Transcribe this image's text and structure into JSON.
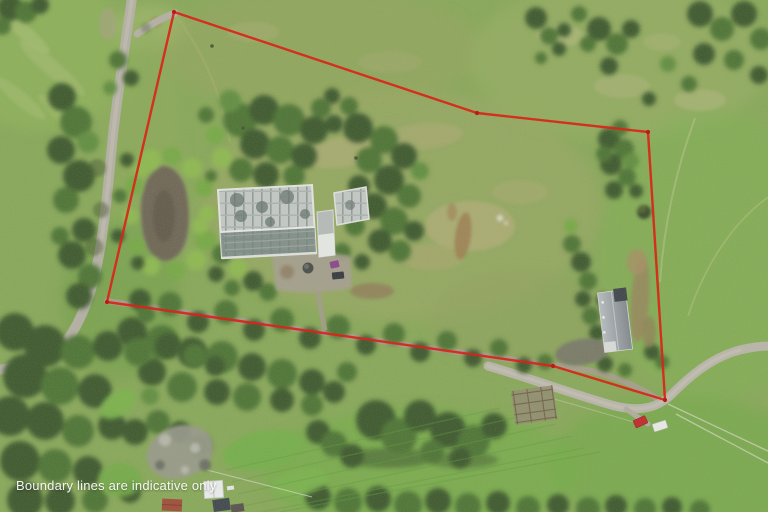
{
  "overlay": {
    "disclaimer": "Boundary lines are indicative only",
    "text_color": "#ffffff"
  },
  "boundary": {
    "color": "#d92518",
    "vertex_color": "#b81d10",
    "stroke_width": 2.4,
    "points": "174,12 477,113 648,132 665,400 553,366 107,302",
    "vertices": [
      [
        174,
        12
      ],
      [
        477,
        113
      ],
      [
        648,
        132
      ],
      [
        665,
        400
      ],
      [
        553,
        366
      ],
      [
        107,
        302
      ]
    ]
  },
  "scene": {
    "kind": "aerial-photograph",
    "features": [
      "rural road",
      "farm pond",
      "glasshouse complex",
      "packing shed",
      "long barn",
      "gravel driveway",
      "tree-lined avenue",
      "cattle yards",
      "parked vehicles",
      "pasture paddocks",
      "shelterbelt trees",
      "small cottages"
    ]
  },
  "palette": {
    "boundary_red": "#d92518",
    "pasture_base": "#87a757",
    "pasture_bright": "#72ac46",
    "paddock_olive": "#9aa662",
    "tree_dark": "#3a572b",
    "road_grey": "#b3afa3",
    "pond_brown": "#6d6353",
    "glasshouse_roof": "#c3c8c4",
    "barn_roof": "#9aa0a4"
  }
}
